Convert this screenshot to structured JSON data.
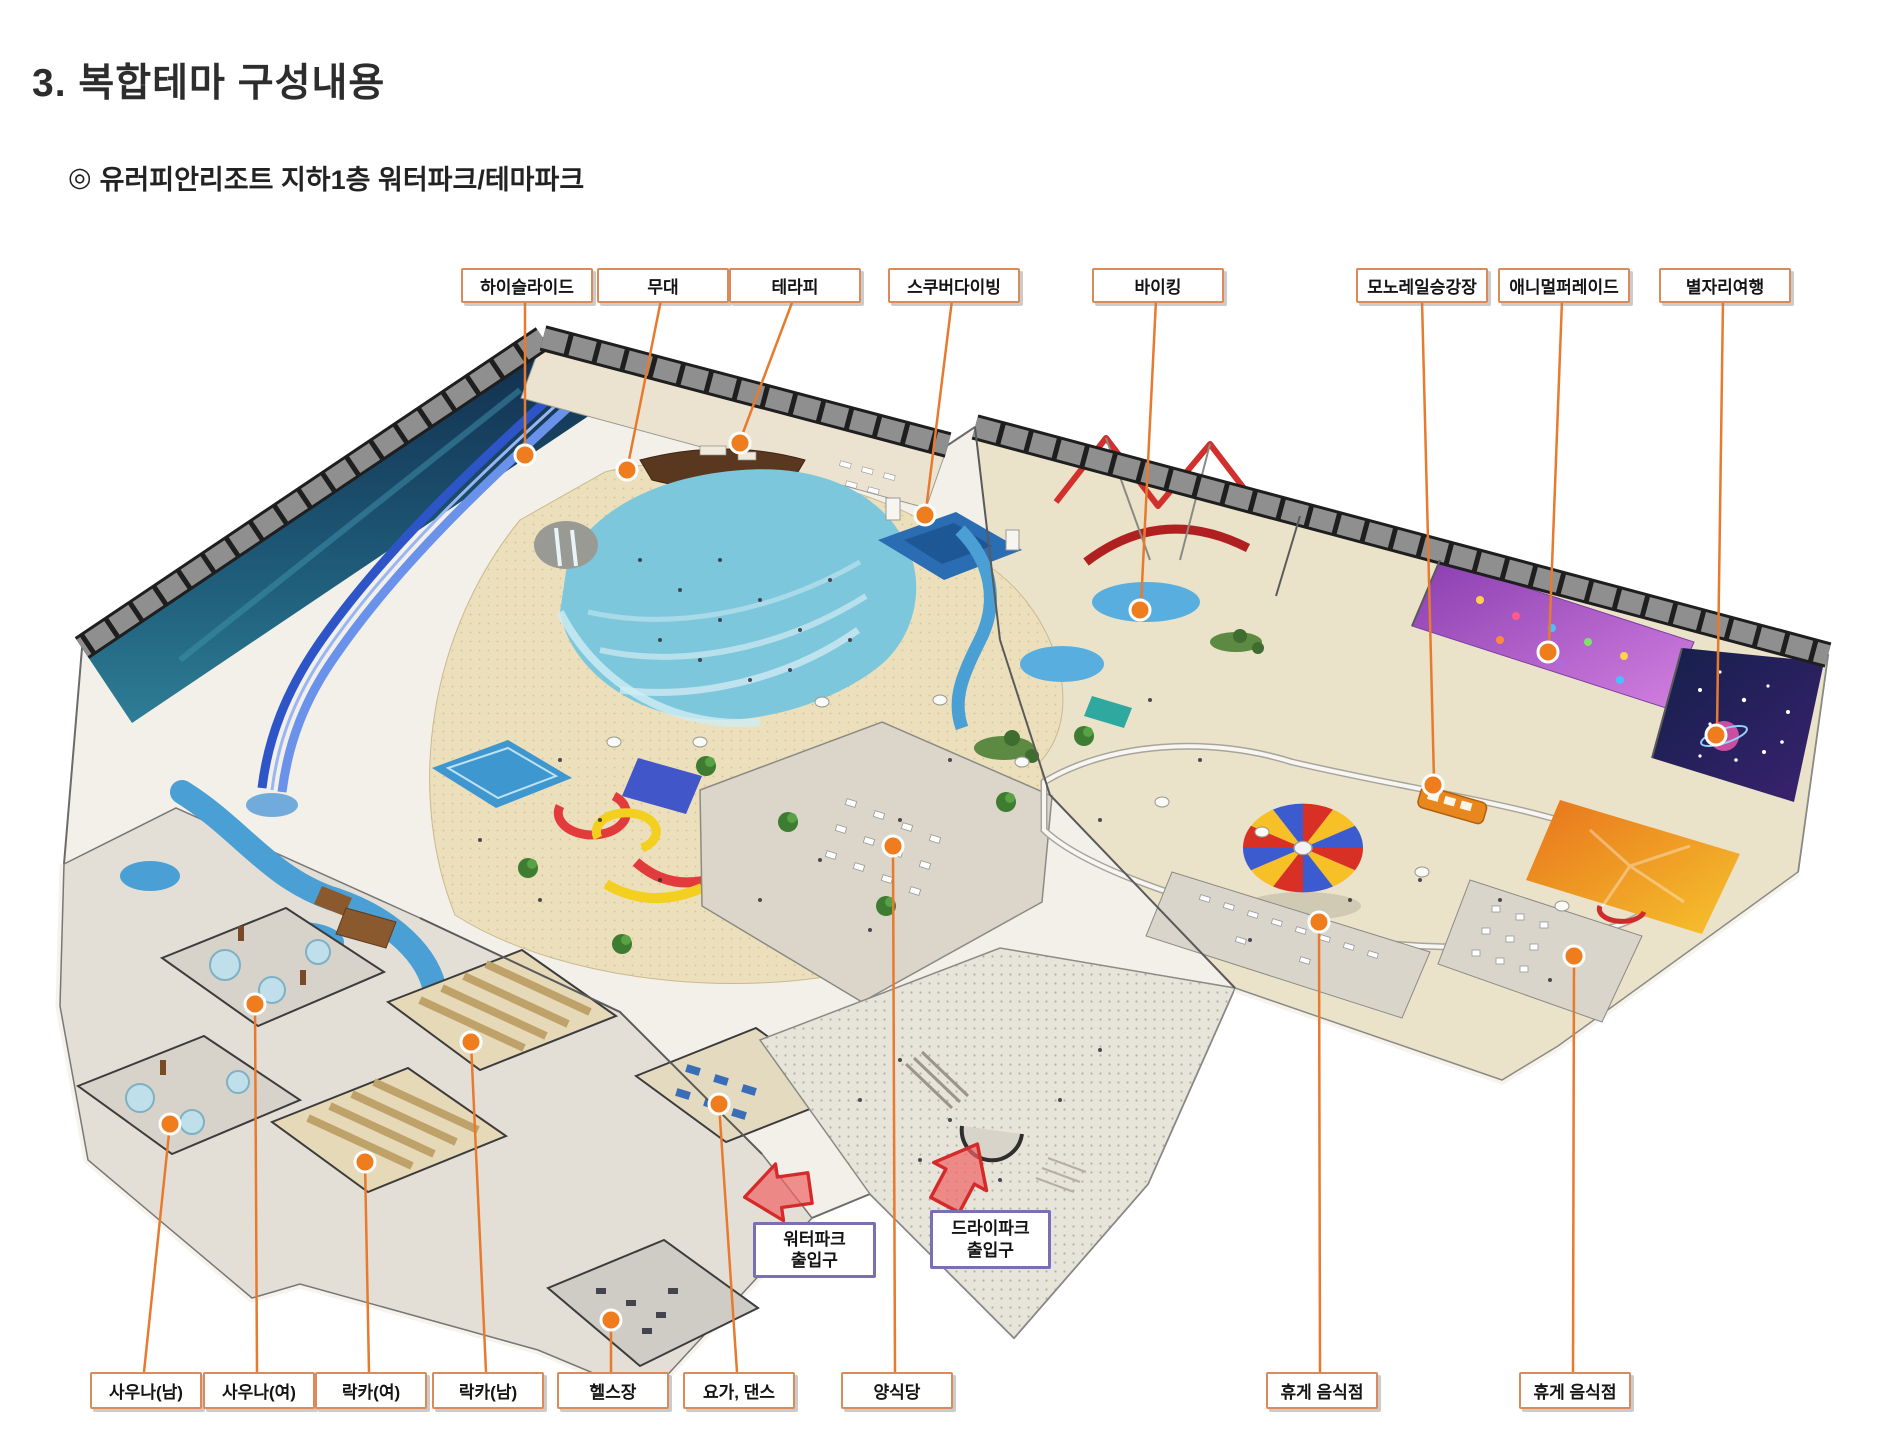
{
  "page": {
    "title": "3. 복합테마 구성내용",
    "subtitle_bullet": "◎",
    "subtitle": "유러피안리조트 지하1층 워터파크/테마파크"
  },
  "map": {
    "callouts_top": [
      {
        "label": "하이슬라이드"
      },
      {
        "label": "무대"
      },
      {
        "label": "테라피"
      },
      {
        "label": "스쿠버다이빙"
      },
      {
        "label": "바이킹"
      },
      {
        "label": "모노레일승강장"
      },
      {
        "label": "애니멀퍼레이드"
      },
      {
        "label": "별자리여행"
      }
    ],
    "callouts_bottom": [
      {
        "label": "사우나(남)"
      },
      {
        "label": "사우나(여)"
      },
      {
        "label": "락카(여)"
      },
      {
        "label": "락카(남)"
      },
      {
        "label": "헬스장"
      },
      {
        "label": "요가, 댄스"
      },
      {
        "label": "양식당"
      },
      {
        "label": "휴게 음식점"
      },
      {
        "label": "휴게 음식점"
      }
    ],
    "entrance_callouts": [
      {
        "line1": "워터파크",
        "line2": "출입구"
      },
      {
        "line1": "드라이파크",
        "line2": "출입구"
      }
    ],
    "viking_sign": "VIKING"
  },
  "colors": {
    "callout_border": "#dd8a5a",
    "leader_line": "#e87a2e",
    "marker_orange": "#ef7d1e",
    "entrance_border": "#7a6fb3",
    "arrow_red": "#e04040",
    "wave_pool_blue": "#7cc7dc",
    "deep_pool_blue": "#2a6db3",
    "sand_beige": "#ecdfbc",
    "mural_navy": "#14304f",
    "carousel_red": "#d93025",
    "carousel_yellow": "#f6c026",
    "carousel_blue": "#3b5bce",
    "roof_band_dark": "#1e1e1e"
  }
}
